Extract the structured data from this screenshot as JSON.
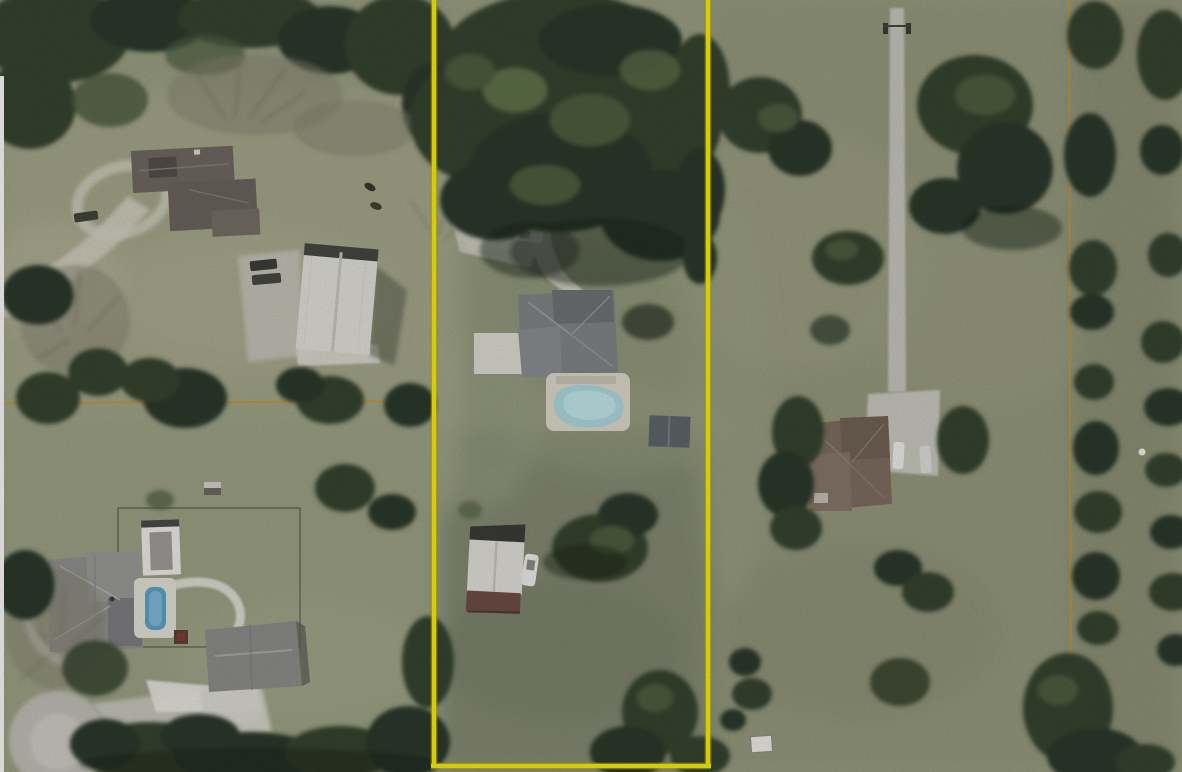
{
  "image": {
    "kind": "aerial-parcel-photo",
    "width": 1182,
    "height": 772,
    "description": "Aerial/orthophoto view of three rural residential lots; the center lot is outlined with a bright yellow parcel boundary; thin orange survey lines cross the left lot horizontally and the right lot vertically"
  },
  "colors": {
    "boundary_yellow": "#f2e80a",
    "boundary_yellow_edge": "#b09e08",
    "survey_orange": "#c8922f",
    "grass_base": "#989c80",
    "grass_light": "#aeac8f",
    "grass_dark": "#767d66",
    "forest_dark": "#2e3a2a",
    "forest_mid": "#3a4833",
    "forest_light": "#5c6f47",
    "pavement_gray": "#c7c5bb",
    "concrete_white": "#e4e3dc",
    "gravel": "#c2c0b6",
    "pool_blue_left": "#5d9ec2",
    "pool_blue_middle": "#a9d4da",
    "pool_deck": "#d8d4c6",
    "roof_gray_mid_house": "#7e8284",
    "roof_gray_bl_house": "#8e8e8c",
    "roof_brown_right_house": "#7b6b5e",
    "roof_brown_tl_house": "#6e665f",
    "barn_white": "#dcdbd5",
    "barn_red": "#6d4b44",
    "shed_gray": "#5d6369",
    "white_strip": "#f5f5f3",
    "vehicle_white": "#ececе8"
  },
  "parcels": {
    "center_outlined": {
      "boundary": "yellow outline: two vertical lines full height plus bottom line",
      "features": [
        "dense-tree-canopy-top",
        "curved-driveway-with-white-car",
        "gray-hip-roof-house",
        "swimming-pool-with-deck",
        "small-gray-shed",
        "white-and-red-barn-with-boat",
        "open-pasture",
        "scattered-trees"
      ]
    },
    "left": {
      "features": [
        "brown-roof-house-with-loop-driveway",
        "white-metal-barn-with-gravel-yard",
        "dirt-road-from-left-edge",
        "orange-survey-line-horizontal",
        "fenced-yard",
        "pool-house",
        "lap-pool",
        "gray-hip-roof-house",
        "garage-house",
        "cul-de-sac-road",
        "tree-band-top",
        "tree-band-bottom",
        "two-horses-in-pasture"
      ]
    },
    "right": {
      "features": [
        "long-straight-concrete-driveway-with-gate",
        "brown-hip-roof-house",
        "two-parked-cars",
        "orange-survey-line-vertical",
        "orchard-tree-rows",
        "scattered-oaks",
        "small-white-shed-bottom",
        "white-trailer-specks"
      ]
    }
  }
}
